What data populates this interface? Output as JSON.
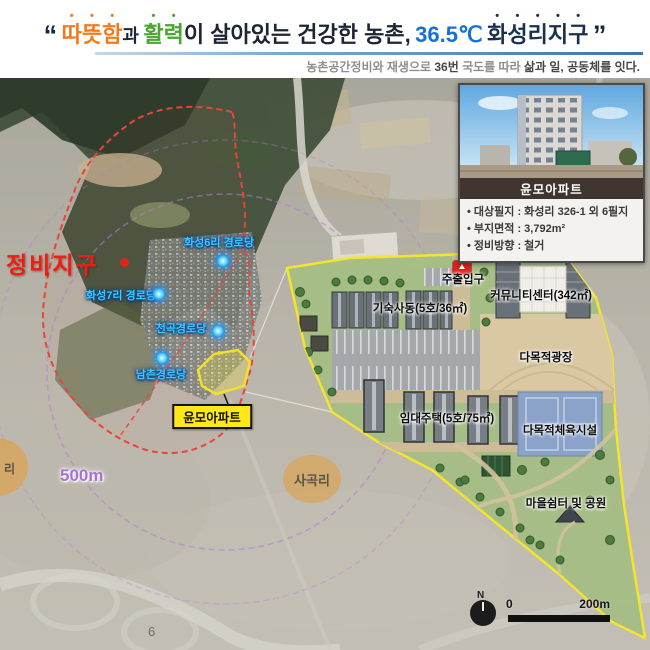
{
  "header": {
    "quote_open": "“",
    "quote_close": "”",
    "title": {
      "warm": "따뜻함",
      "particle": "과",
      "vitality": "활력",
      "middle": "이 살아있는 건강한 농촌,",
      "temperature": "36.5℃",
      "district": "화성리지구"
    },
    "subtitle": {
      "lead": "농촌공간정비와 재생으로 ",
      "highway_no": "36번",
      "mid": " 국도를 따라 ",
      "bold_tail": "삶과 일, 공동체를 잇다."
    }
  },
  "map": {
    "district_zone_label": "정비지구",
    "poi": [
      {
        "label": "화성6리 경로당"
      },
      {
        "label": "화성7리 경로당"
      },
      {
        "label": "천곡경로당"
      },
      {
        "label": "남촌경로당"
      }
    ],
    "apartment_callout": "윤모아파트",
    "village_label": "사곡리",
    "left_edge_label": "리",
    "radius_label": "500m",
    "page_number": "6"
  },
  "inset": {
    "caption": "윤모아파트",
    "bullets": [
      "• 대상필지 : 화성리 326-1 외 6필지",
      "• 부지면적 : 3,792m²",
      "• 정비방향 : 철거"
    ]
  },
  "siteplan": {
    "entrance": "주출입구",
    "dormitory": "기숙사동(5호/36㎡)",
    "community_center": "커뮤니티센터(342㎡)",
    "plaza": "다목적광장",
    "rental_housing": "임대주택(5호/75㎡)",
    "sports_facility": "다목적체육시설",
    "park": "마을쉼터 및 공원"
  },
  "scalebar": {
    "north": "N",
    "zero": "0",
    "max": "200m"
  },
  "colors": {
    "accent_orange": "#f07c1e",
    "accent_green": "#4aa62e",
    "accent_blue": "#1670d8",
    "navy": "#17304f",
    "district_red": "#ea2015",
    "boundary_yellow": "#f4e430",
    "poi_blue": "#41c6ff"
  }
}
